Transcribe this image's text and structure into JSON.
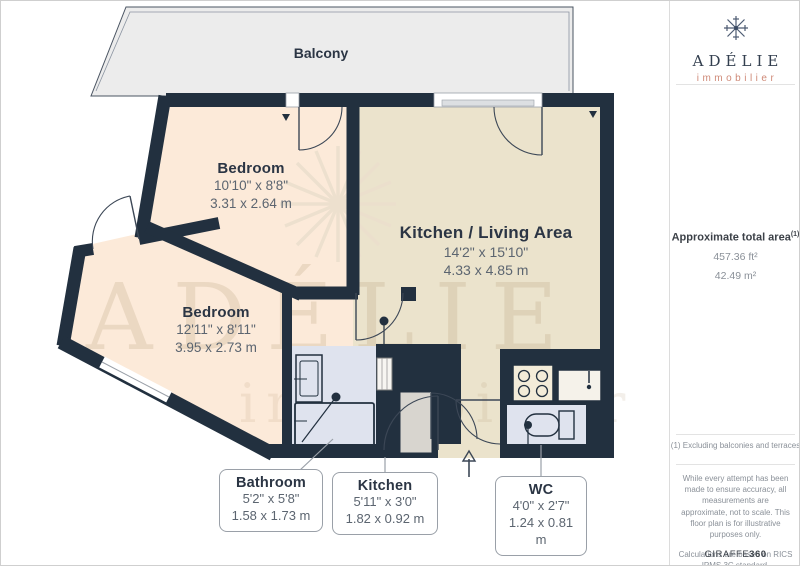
{
  "logo": {
    "brand": "ADÉLIE",
    "tagline": "immobilier"
  },
  "sidebar": {
    "area_title": "Approximate total area",
    "area_superscript": "(1)",
    "area_ft": "457.36 ft²",
    "area_m": "42.49 m²",
    "footnote": "(1) Excluding balconies and terraces",
    "disclaimer": "While every attempt has been made to ensure accuracy, all measurements are approximate, not to scale. This floor plan is for illustrative purposes only.",
    "standard": "Calculations are based on RICS IPMS 3C standard.",
    "brand_footer_name": "GIRAFFE",
    "brand_footer_number": "360"
  },
  "floorplan": {
    "balcony_label": "Balcony",
    "watermark_brand": "ADÉLIE",
    "watermark_tagline": "immobilier",
    "rooms": [
      {
        "name": "Bedroom",
        "imperial": "10'10\" x 8'8\"",
        "metric": "3.31 x 2.64 m"
      },
      {
        "name": "Bedroom",
        "imperial": "12'11\" x 8'11\"",
        "metric": "3.95 x 2.73 m"
      },
      {
        "name": "Kitchen / Living Area",
        "imperial": "14'2\" x 15'10\"",
        "metric": "4.33 x 4.85 m"
      }
    ],
    "callouts": [
      {
        "name": "Bathroom",
        "imperial": "5'2\" x 5'8\"",
        "metric": "1.58 x 1.73 m"
      },
      {
        "name": "Kitchen",
        "imperial": "5'11\" x 3'0\"",
        "metric": "1.82 x 0.92 m"
      },
      {
        "name": "WC",
        "imperial": "4'0\" x 2'7\"",
        "metric": "1.24 x 0.81 m"
      }
    ]
  },
  "colors": {
    "wall": "#22303f",
    "bedroom_fill": "#fcead9",
    "living_fill": "#ebe3cc",
    "wet_fill": "#dfe3ee",
    "balcony_fill": "#ececec",
    "counter_fill": "#d8d5cf",
    "accent_salmon": "#cf8a78",
    "navy_text": "#2b3544",
    "dim_text": "#5c6570",
    "line_gray": "#9aa0a8"
  }
}
